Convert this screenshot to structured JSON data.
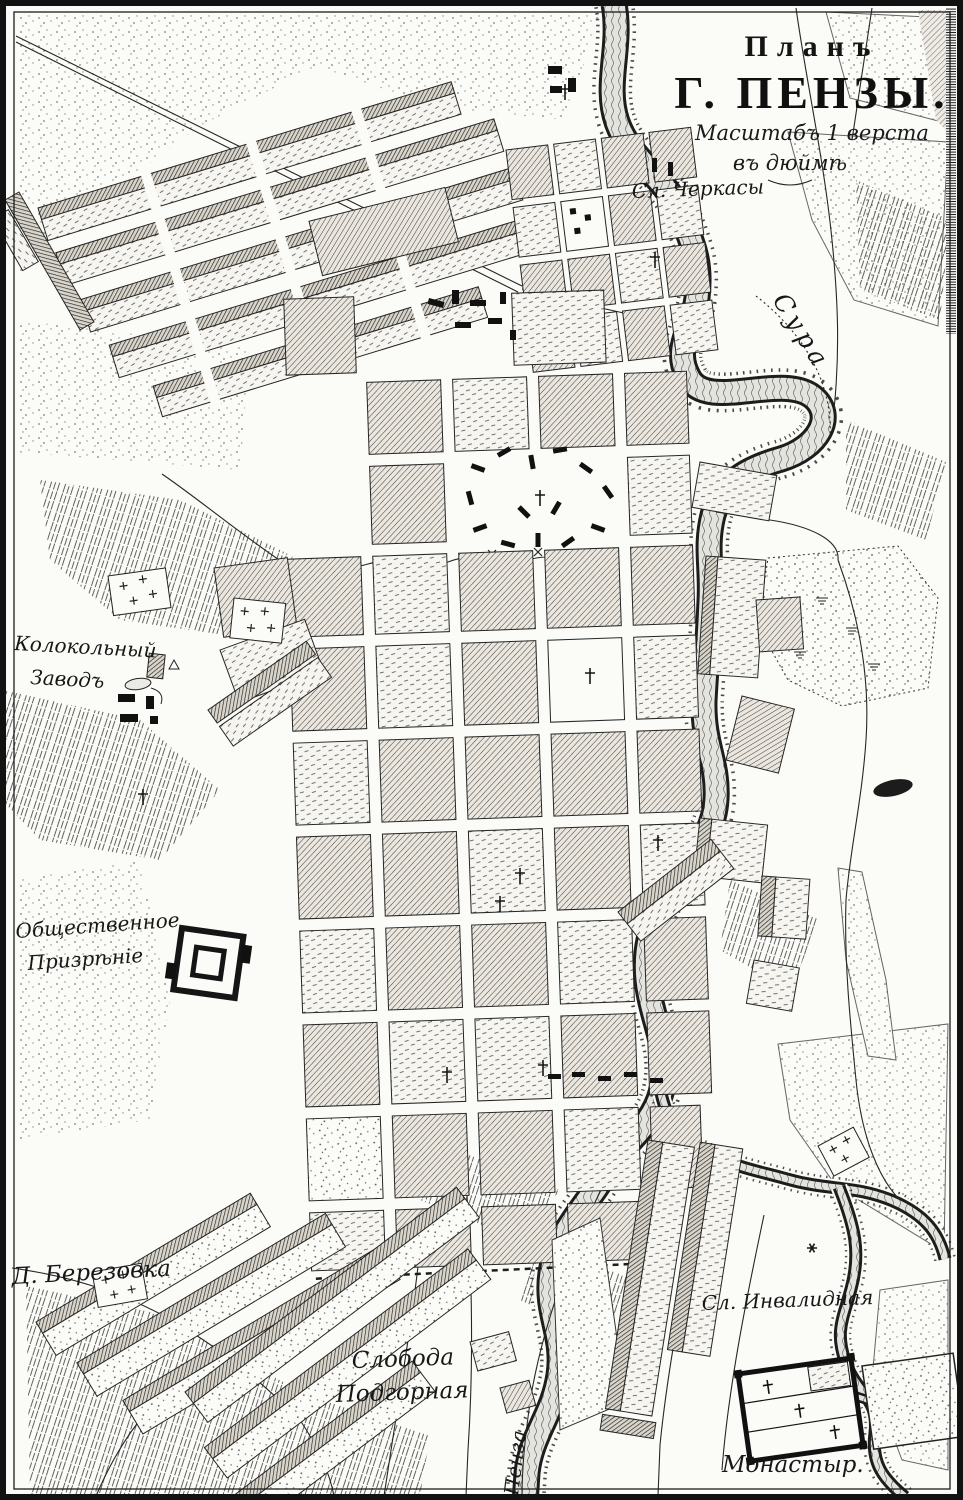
{
  "map": {
    "title": {
      "line1": "Планъ",
      "line2": "Г. ПЕНЗЫ.",
      "scale1": "Масштабъ 1 верста",
      "scale2": "въ дюймѣ"
    },
    "labels": {
      "cherkasy": "Сл. Черкасы",
      "sura_river": "Сура",
      "bell_factory_line1": "Колокольный",
      "bell_factory_line2": "Заводъ",
      "public_charity_line1": "Общественное",
      "public_charity_line2": "Призрѣніе",
      "berezovka": "Д. Березовка",
      "podgornaya_line1": "Слобода",
      "podgornaya_line2": "Подгорная",
      "invalidnaya": "Сл. Инвалидная",
      "monastery": "Монастыр.",
      "penza_river": "Пенза"
    },
    "colors": {
      "ink": "#1a1a1a",
      "paper": "#fbfbf8",
      "water": "#e4e4df",
      "block_gray": "#ebe7df"
    }
  }
}
